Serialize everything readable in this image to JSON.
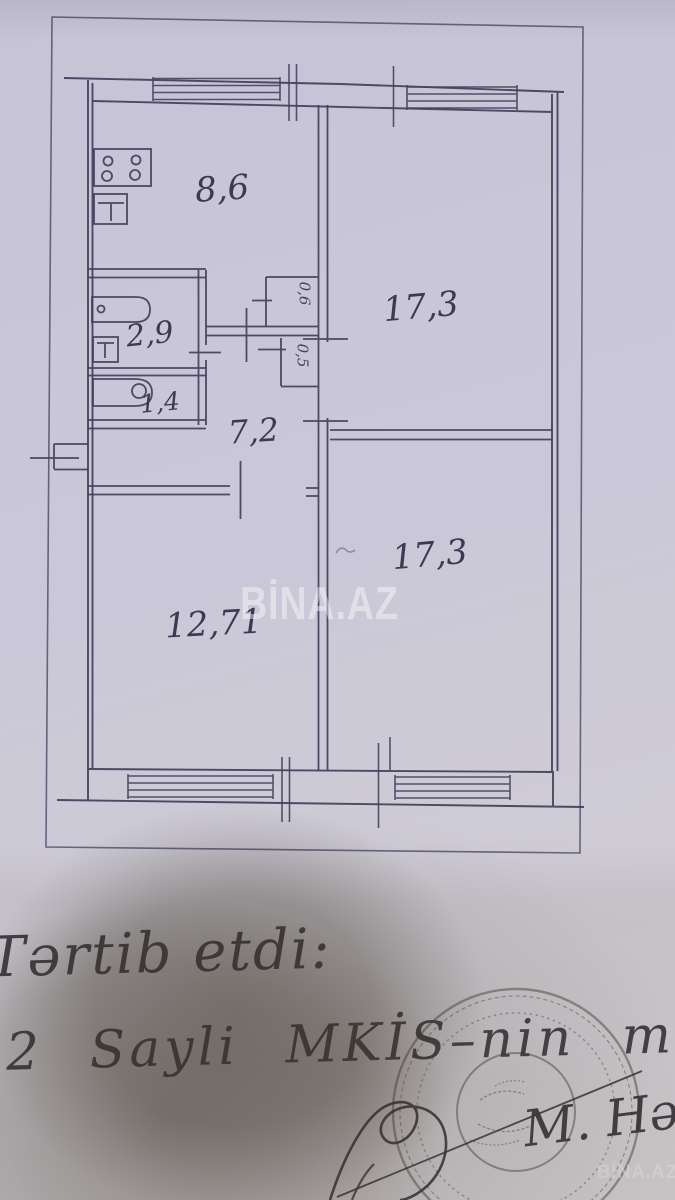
{
  "watermarks": {
    "center": "BİNA.AZ",
    "corner": "BİNA.AZ"
  },
  "rooms": {
    "kitchen": "8,6",
    "living_top": "17,3",
    "bath": "2,9",
    "wc": "1,4",
    "hall": "7,2",
    "living_bottom": "17,3",
    "bedroom": "12,71",
    "closet_top": "0,6",
    "closet_bottom": "0,5"
  },
  "handwriting": {
    "line1": "Tərtib etdi:",
    "line2": "2 Sayli MKİS–nin m",
    "initials": "M. Hə"
  },
  "colors": {
    "ink": "#413f5a",
    "paper": "#c9c7d7",
    "handwriting": "#2e2b33",
    "stamp": "#4f4b48",
    "watermark": "#ffffff"
  }
}
